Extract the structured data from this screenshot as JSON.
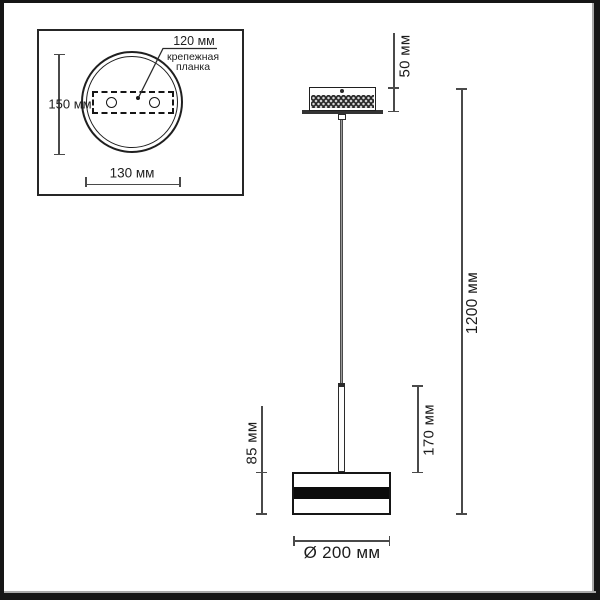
{
  "diagram": {
    "inset": {
      "plate_width": "120 мм",
      "plate_label_line1": "крепежная",
      "plate_label_line2": "планка",
      "canopy_diameter_vertical": "150 мм",
      "holes_spacing": "130 мм"
    },
    "main": {
      "canopy_height": "50 мм",
      "overall_drop": "1200 мм",
      "stem_length": "170 мм",
      "shade_height": "85 мм",
      "shade_diameter": "Ø 200 мм"
    },
    "colors": {
      "outline": "#1f1f1f",
      "dimension_line": "#4a4a4a",
      "shade_band": "#0c0c0c",
      "frame": "#161616"
    }
  }
}
